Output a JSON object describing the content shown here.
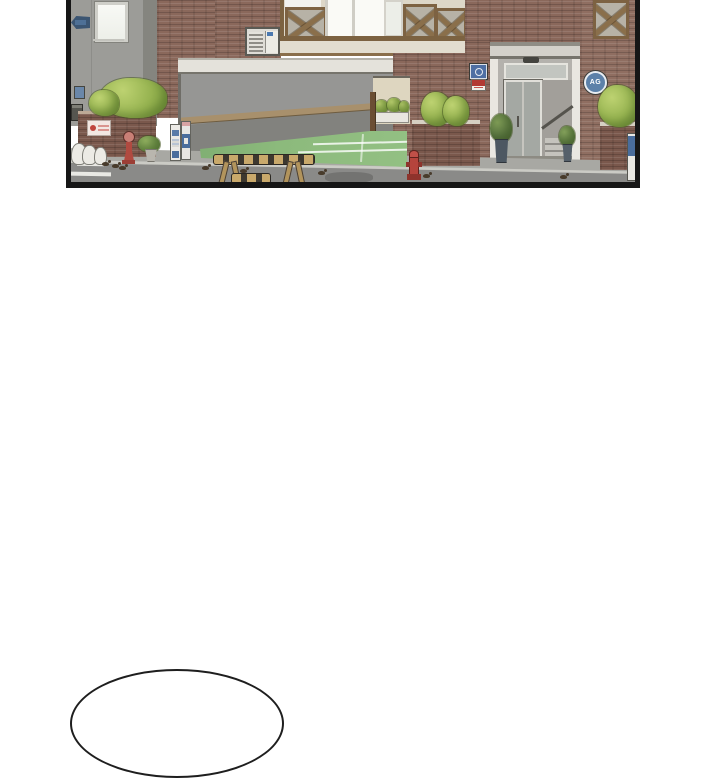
{
  "scene": {
    "description": "Webtoon comic panel: street view of a brick half-timbered building with a parking garage ramp, green driveway apron, landscaped brick planters, a recessed glass entrance with stairs, vending machines, fire hydrants, wooden traffic barriers and small birds on the road",
    "bubble_text": ""
  },
  "panel": {
    "entrance_badge_label": "AG"
  },
  "colors": {
    "panel_border": "#161616",
    "brick": "#8a685b",
    "bush_green": "#96b350",
    "turf_green": "#8cba7c",
    "street_gray": "#8a8a88",
    "sidewalk_gray": "#a8a8a3",
    "hydrant_red": "#b5443c",
    "sign_blue": "#4e6fa3",
    "badge_blue": "#5d81a9",
    "wood_beam": "#7d6242",
    "page_background": "#ffffff"
  }
}
